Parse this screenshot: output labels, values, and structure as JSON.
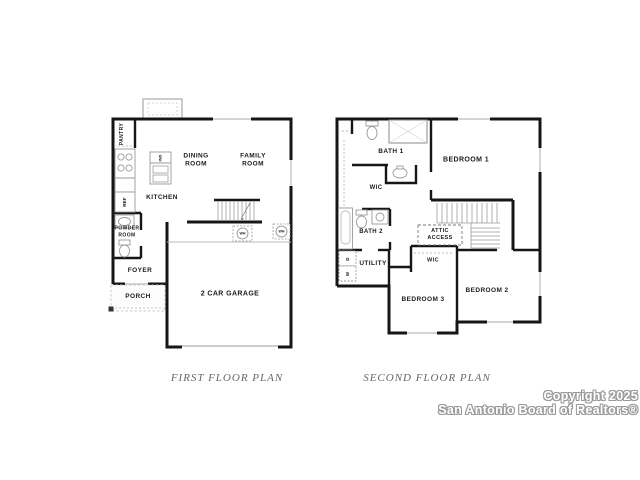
{
  "first_floor": {
    "caption": "FIRST FLOOR PLAN",
    "labels": {
      "pantry": "PANTRY",
      "island": "IND",
      "kitchen": "KITCHEN",
      "dining_room": "DINING\nROOM",
      "family_room": "FAMILY\nROOM",
      "ref": "REF",
      "powder_room": "POWDER\nROOM",
      "foyer": "FOYER",
      "porch": "PORCH",
      "garage": "2 CAR GARAGE",
      "water_heater_1": "WH",
      "water_heater_2": "WH"
    }
  },
  "second_floor": {
    "caption": "SECOND FLOOR PLAN",
    "labels": {
      "bath1": "BATH 1",
      "wic_upper": "WIC",
      "bedroom1": "BEDROOM 1",
      "bath2": "BATH 2",
      "attic_access": "ATTIC\nACCESS",
      "utility": "UTILITY",
      "wic_lower": "WIC",
      "bedroom3": "BEDROOM 3",
      "bedroom2": "BEDROOM 2",
      "dryer": "D",
      "washer": "W"
    }
  },
  "watermark": {
    "line1": "Copyright 2025",
    "line2": "San Antonio Board of Realtors®"
  },
  "colors": {
    "wall": "#161616",
    "fixture": "#999999",
    "window": "#c6c6c6",
    "caption_text": "#666666",
    "watermark_fill": "#ffffff",
    "watermark_outline": "#9a9a9a"
  }
}
